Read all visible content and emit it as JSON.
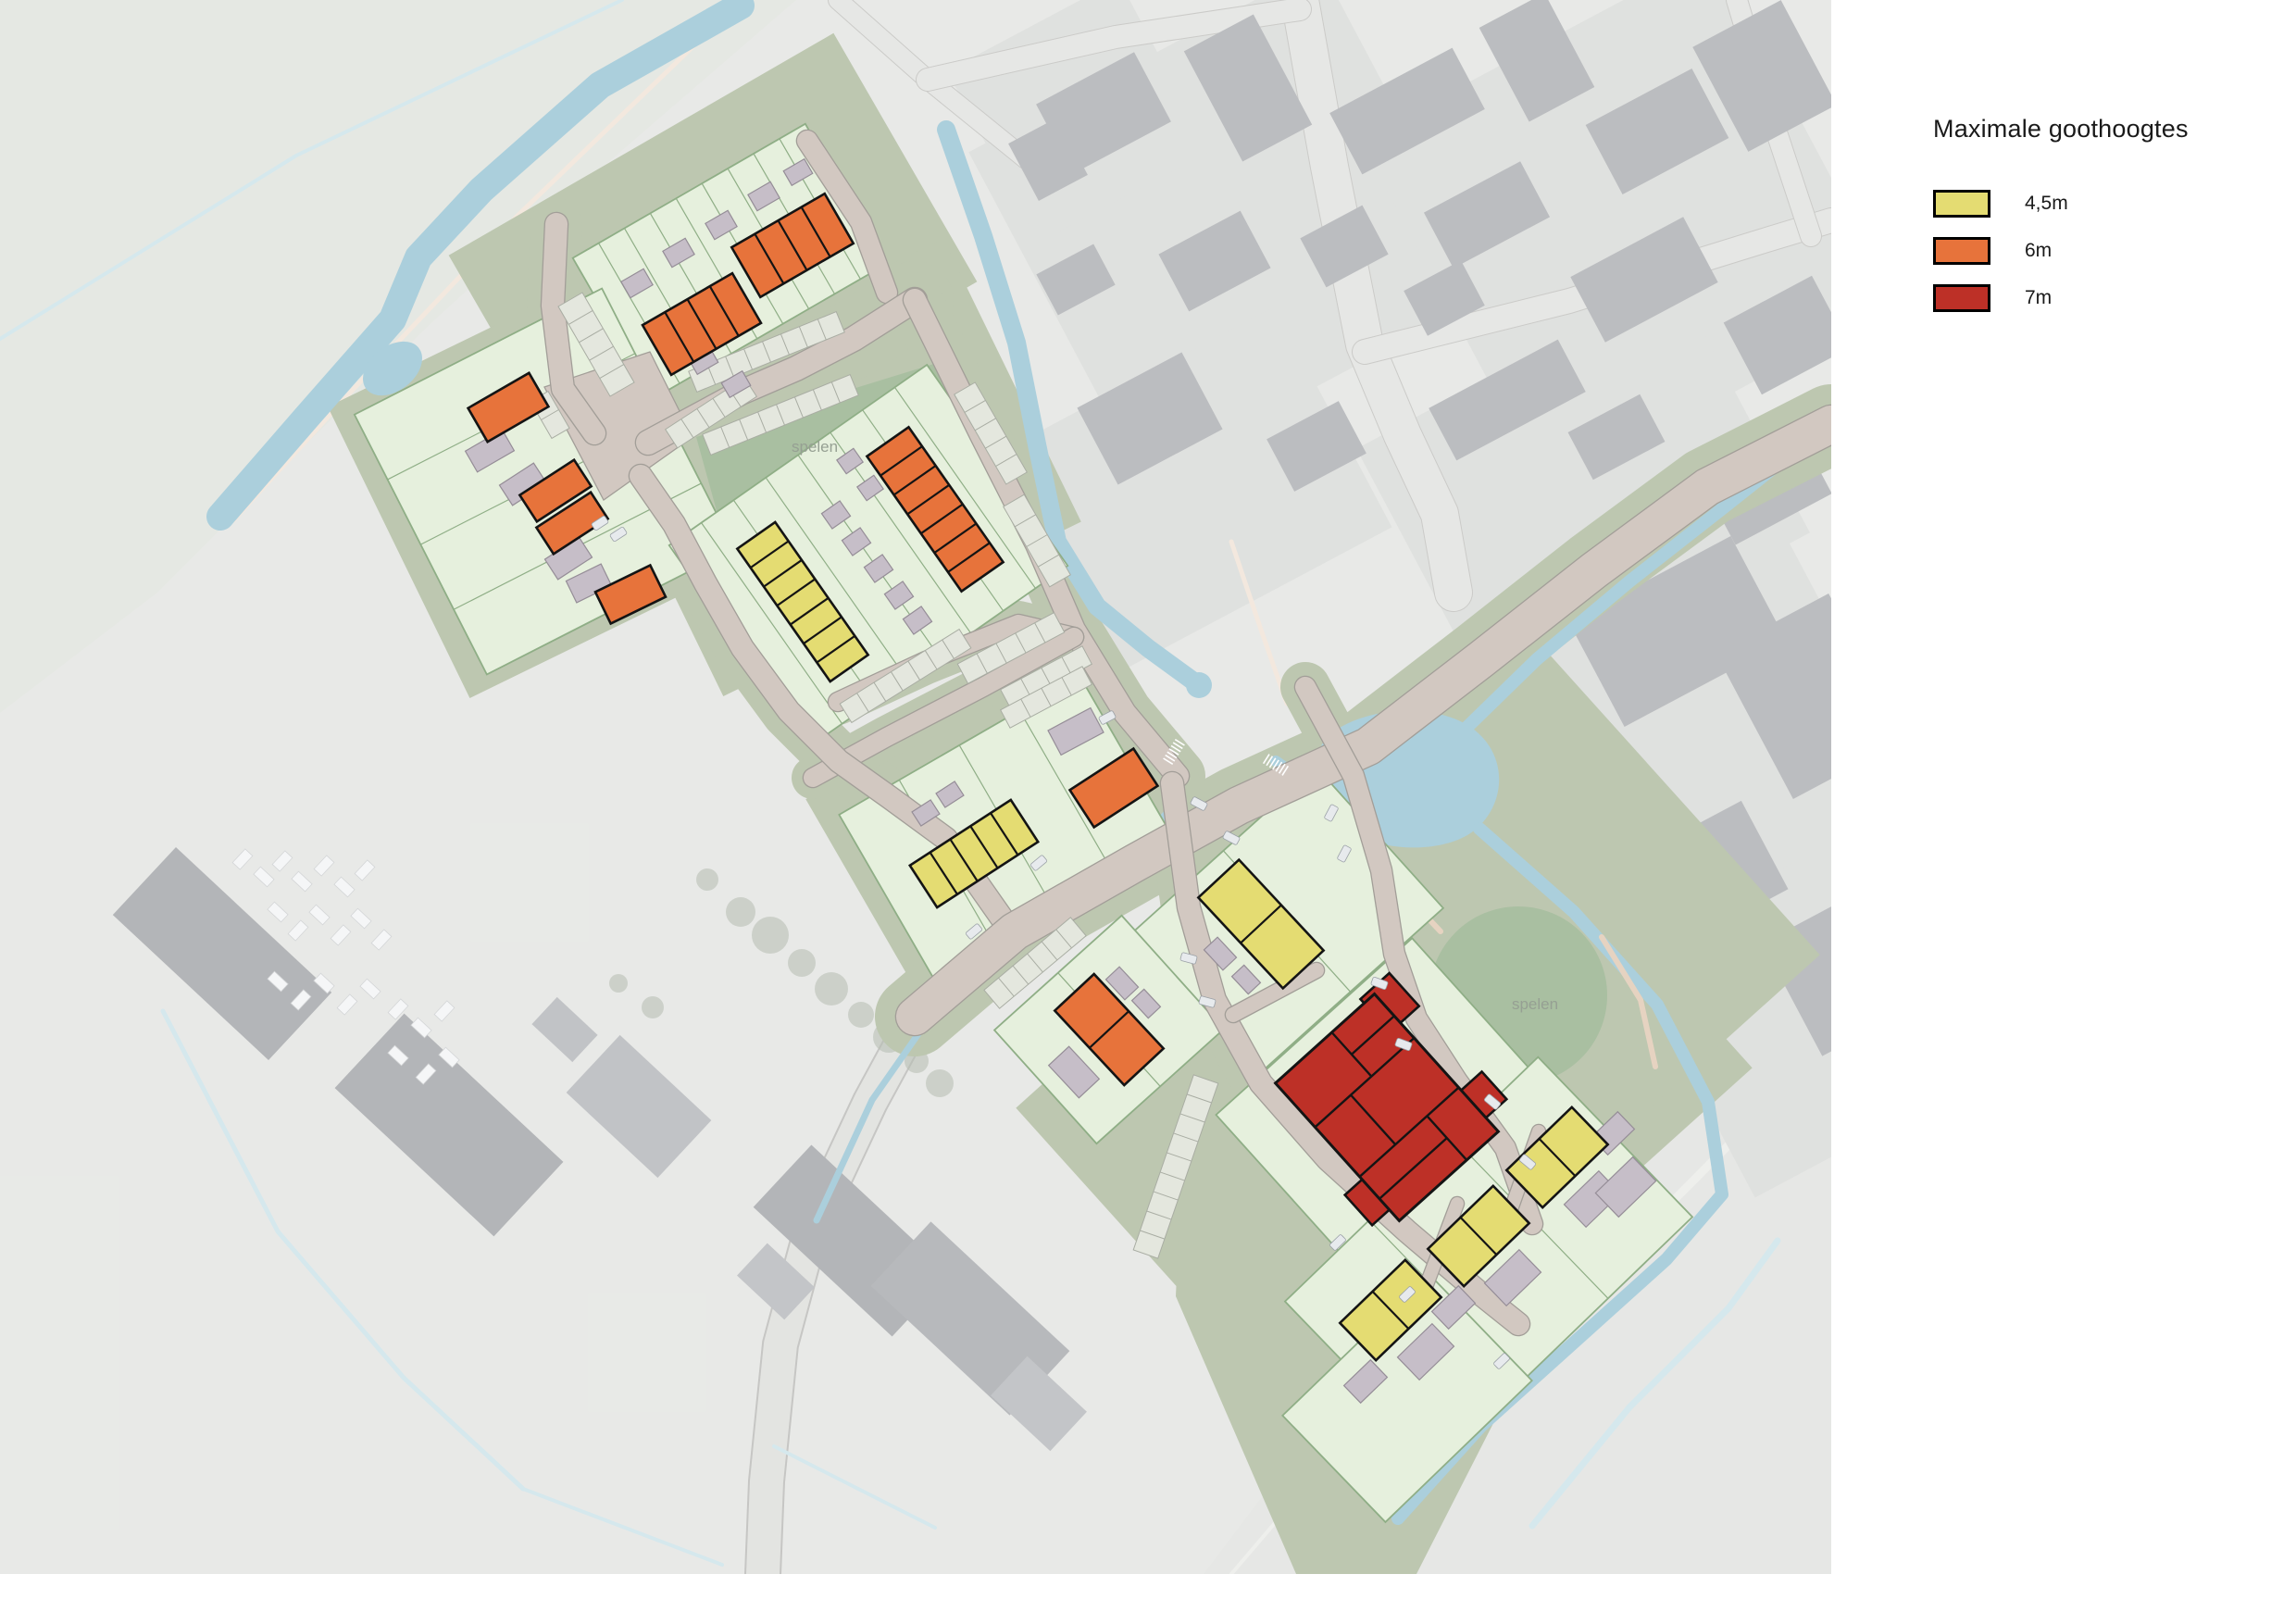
{
  "legend": {
    "title": "Maximale goothoogtes",
    "items": [
      {
        "id": "45m",
        "label": "4,5m",
        "color": "#e4dc72"
      },
      {
        "id": "6m",
        "label": "6m",
        "color": "#e7733b"
      },
      {
        "id": "7m",
        "label": "7m",
        "color": "#bd3027"
      }
    ]
  },
  "map": {
    "play_labels": [
      "spelen",
      "spelen"
    ],
    "colors": {
      "water": "#abcfdc",
      "ditch": "#b7d7e1",
      "parcel": "#e6f0dd",
      "parcel_border": "#8fae86",
      "play_area": "#a9bfa1",
      "plan_base": "#bdc7b0",
      "road": "#d2c8c1",
      "road_border": "#a29e98",
      "parking": "#e4e7de",
      "parking_border": "#a9ada3",
      "shed": "#c6bec8",
      "shed_border": "#958d97",
      "building_outline": "#141414",
      "label_text": "#96a093",
      "aerial_base": "#d8dad6",
      "aerial_field": "#d3d8cf",
      "aerial_building": "#8b8e93",
      "aerial_road": "#d5d6d3"
    }
  }
}
